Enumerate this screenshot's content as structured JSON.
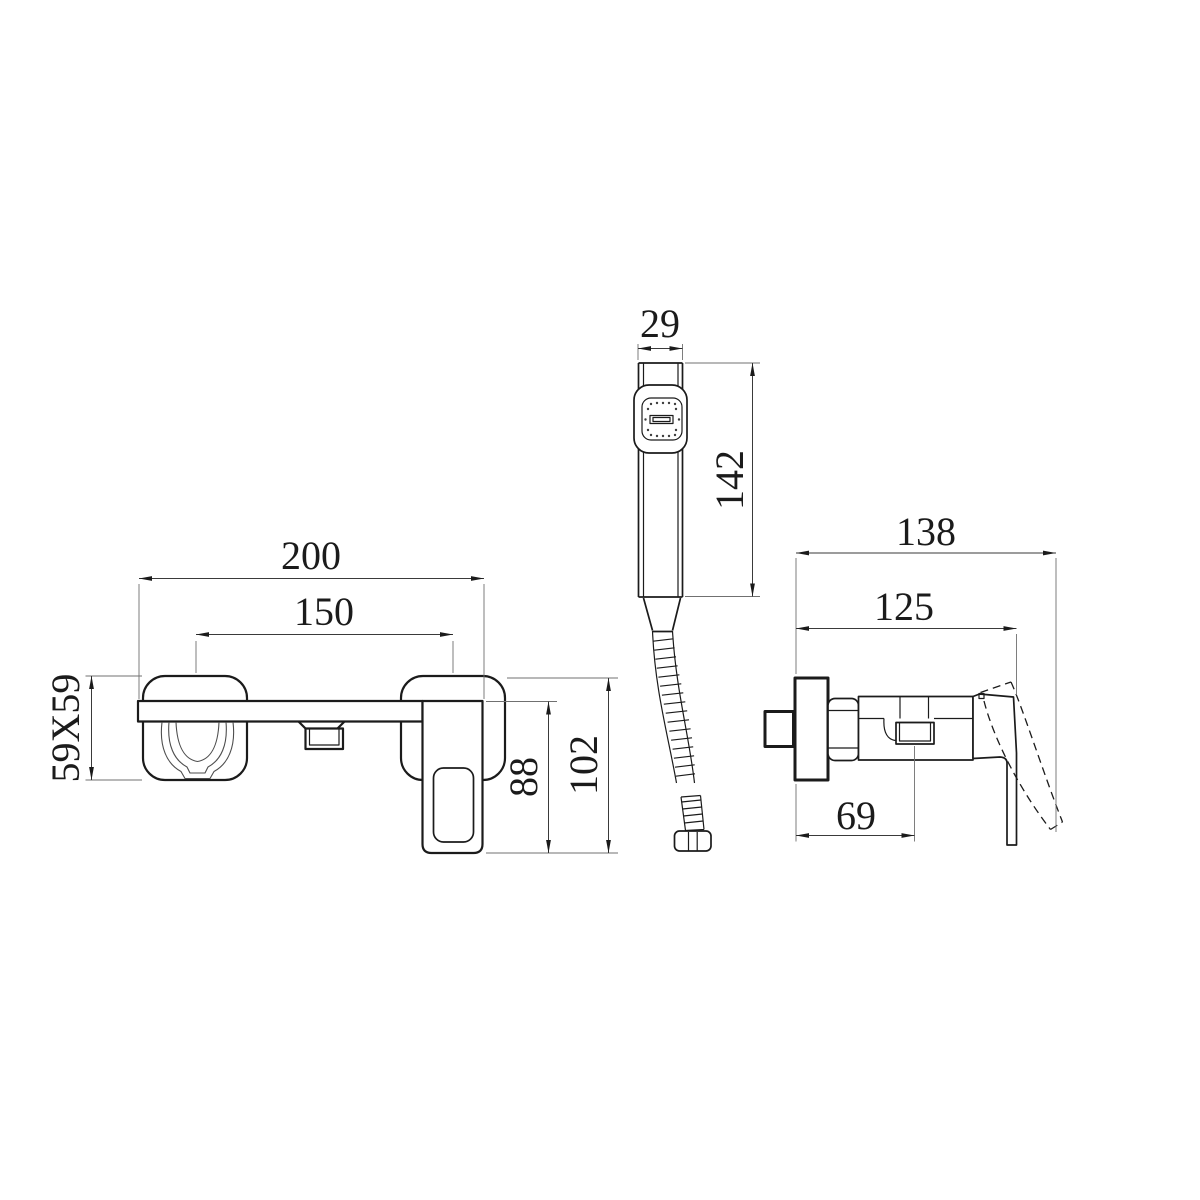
{
  "dimensions": {
    "front": {
      "overall_width": "200",
      "faucet_centers": "150",
      "escutcheon_size": "59X59",
      "handle_height": "88",
      "total_height": "102"
    },
    "hand_shower": {
      "head_width": "29",
      "handle_length": "142"
    },
    "side": {
      "overall_depth": "138",
      "handle_depth": "125",
      "outlet_offset": "69"
    }
  },
  "colors": {
    "background": "#ffffff",
    "line": "#1b1b1b",
    "dimension": "#3a3a3a",
    "extension": "#707070",
    "thin": "#4d4d4d"
  }
}
